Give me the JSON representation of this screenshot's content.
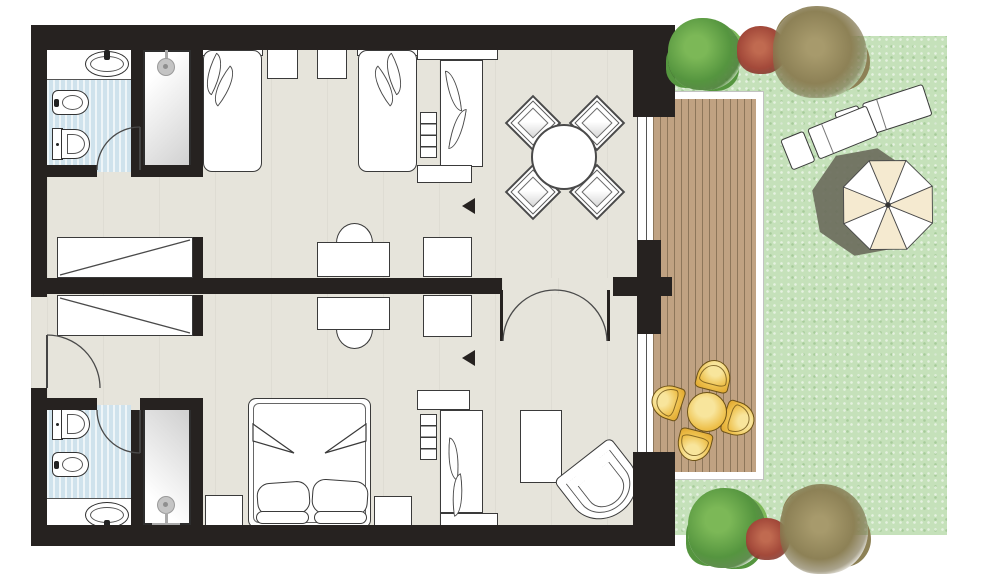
{
  "meta": {
    "type": "architectural-floor-plan",
    "description": "Hotel two-room family suite floor plan: twin-bed room with dining corner, king-bed room, two bathrooms with showers, connecting french doors, wooden deck terrace with outdoor dining set, garden with sun loungers, parasol and shrubs",
    "visible_text": []
  },
  "palette": {
    "wall": "#262220",
    "outline": "#3a3a3a",
    "floor": "#e6e4db",
    "tile": "#cfe2ec",
    "grass": "#c5e1ba",
    "deck": "#c0a282",
    "deck_line": "#8d765a",
    "frame": "#ffffff",
    "gold_hi": "#f8e59c",
    "gold": "#eec14d",
    "gold_dark": "#dfa52c",
    "gold_border": "#6e5316",
    "cream": "#f5ead0",
    "shadow": "#6b6d5c",
    "bush_green": "#55953f",
    "bush_green_hi": "#7cb857",
    "bush_red": "#a3493a",
    "bush_olive": "#8d8156"
  },
  "scene": {
    "rooms": [
      {
        "name": "twin-bedroom-living",
        "furniture": [
          "twin-bed",
          "twin-bed",
          "nightstand",
          "nightstand",
          "desk-with-chair",
          "cabinet",
          "wardrobe-with-shelves",
          "dining-table-round",
          "dining-chair x4",
          "built-in-closet"
        ]
      },
      {
        "name": "king-bedroom",
        "furniture": [
          "king-bed",
          "nightstand",
          "nightstand",
          "desk-with-chair",
          "cabinet",
          "wardrobe-with-shelves",
          "ottoman",
          "corner-armchair",
          "built-in-closet"
        ]
      },
      {
        "name": "bathroom-upper",
        "fixtures": [
          "sink",
          "bidet",
          "toilet",
          "shower"
        ]
      },
      {
        "name": "bathroom-lower",
        "fixtures": [
          "sink",
          "bidet",
          "toilet",
          "shower"
        ]
      },
      {
        "name": "terrace-deck",
        "furniture": [
          "outdoor-table-round",
          "outdoor-chair x4"
        ]
      },
      {
        "name": "garden",
        "items": [
          "sun-lounger x2",
          "parasol",
          "shrub x6",
          "lawn"
        ]
      }
    ],
    "doors": [
      "entry-door",
      "bathroom-door-upper",
      "bathroom-door-lower",
      "connecting-french-doors"
    ]
  }
}
